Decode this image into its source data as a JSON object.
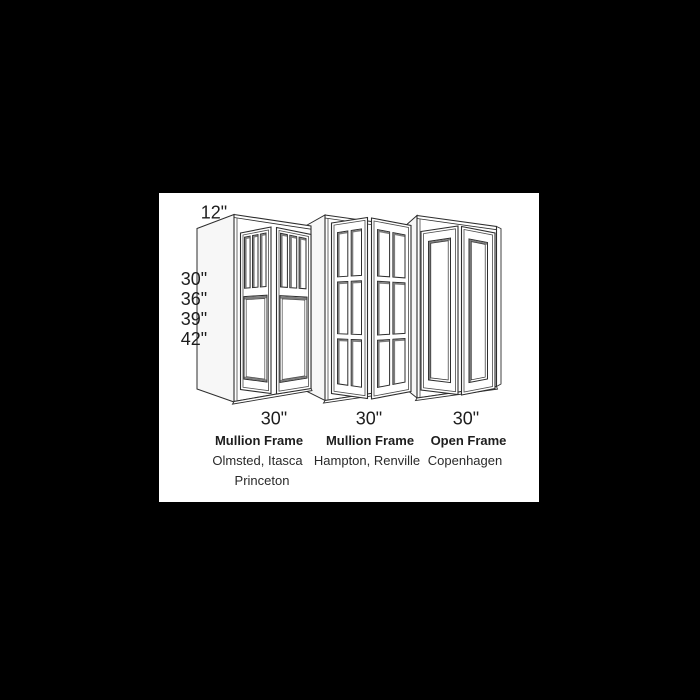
{
  "theme": {
    "background": "#000000",
    "canvas_background": "#ffffff",
    "line_color": "#2e2e2e",
    "inner_line_color": "#4a4a4a",
    "shade_color": "#7d7d7d",
    "side_panel_color": "#f7f7f7",
    "text_color": "#1e1e1e"
  },
  "diagram": {
    "depth_label": "12\"",
    "height_labels": [
      "30\"",
      "36\"",
      "39\"",
      "42\""
    ],
    "cabinets": [
      {
        "width_label": "30\"",
        "frame_type": "Mullion Frame",
        "style_names": [
          "Olmsted, Itasca",
          "Princeton"
        ]
      },
      {
        "width_label": "30\"",
        "frame_type": "Mullion Frame",
        "style_names": [
          "Hampton, Renville"
        ]
      },
      {
        "width_label": "30\"",
        "frame_type": "Open Frame",
        "style_names": [
          "Copenhagen"
        ]
      }
    ]
  }
}
